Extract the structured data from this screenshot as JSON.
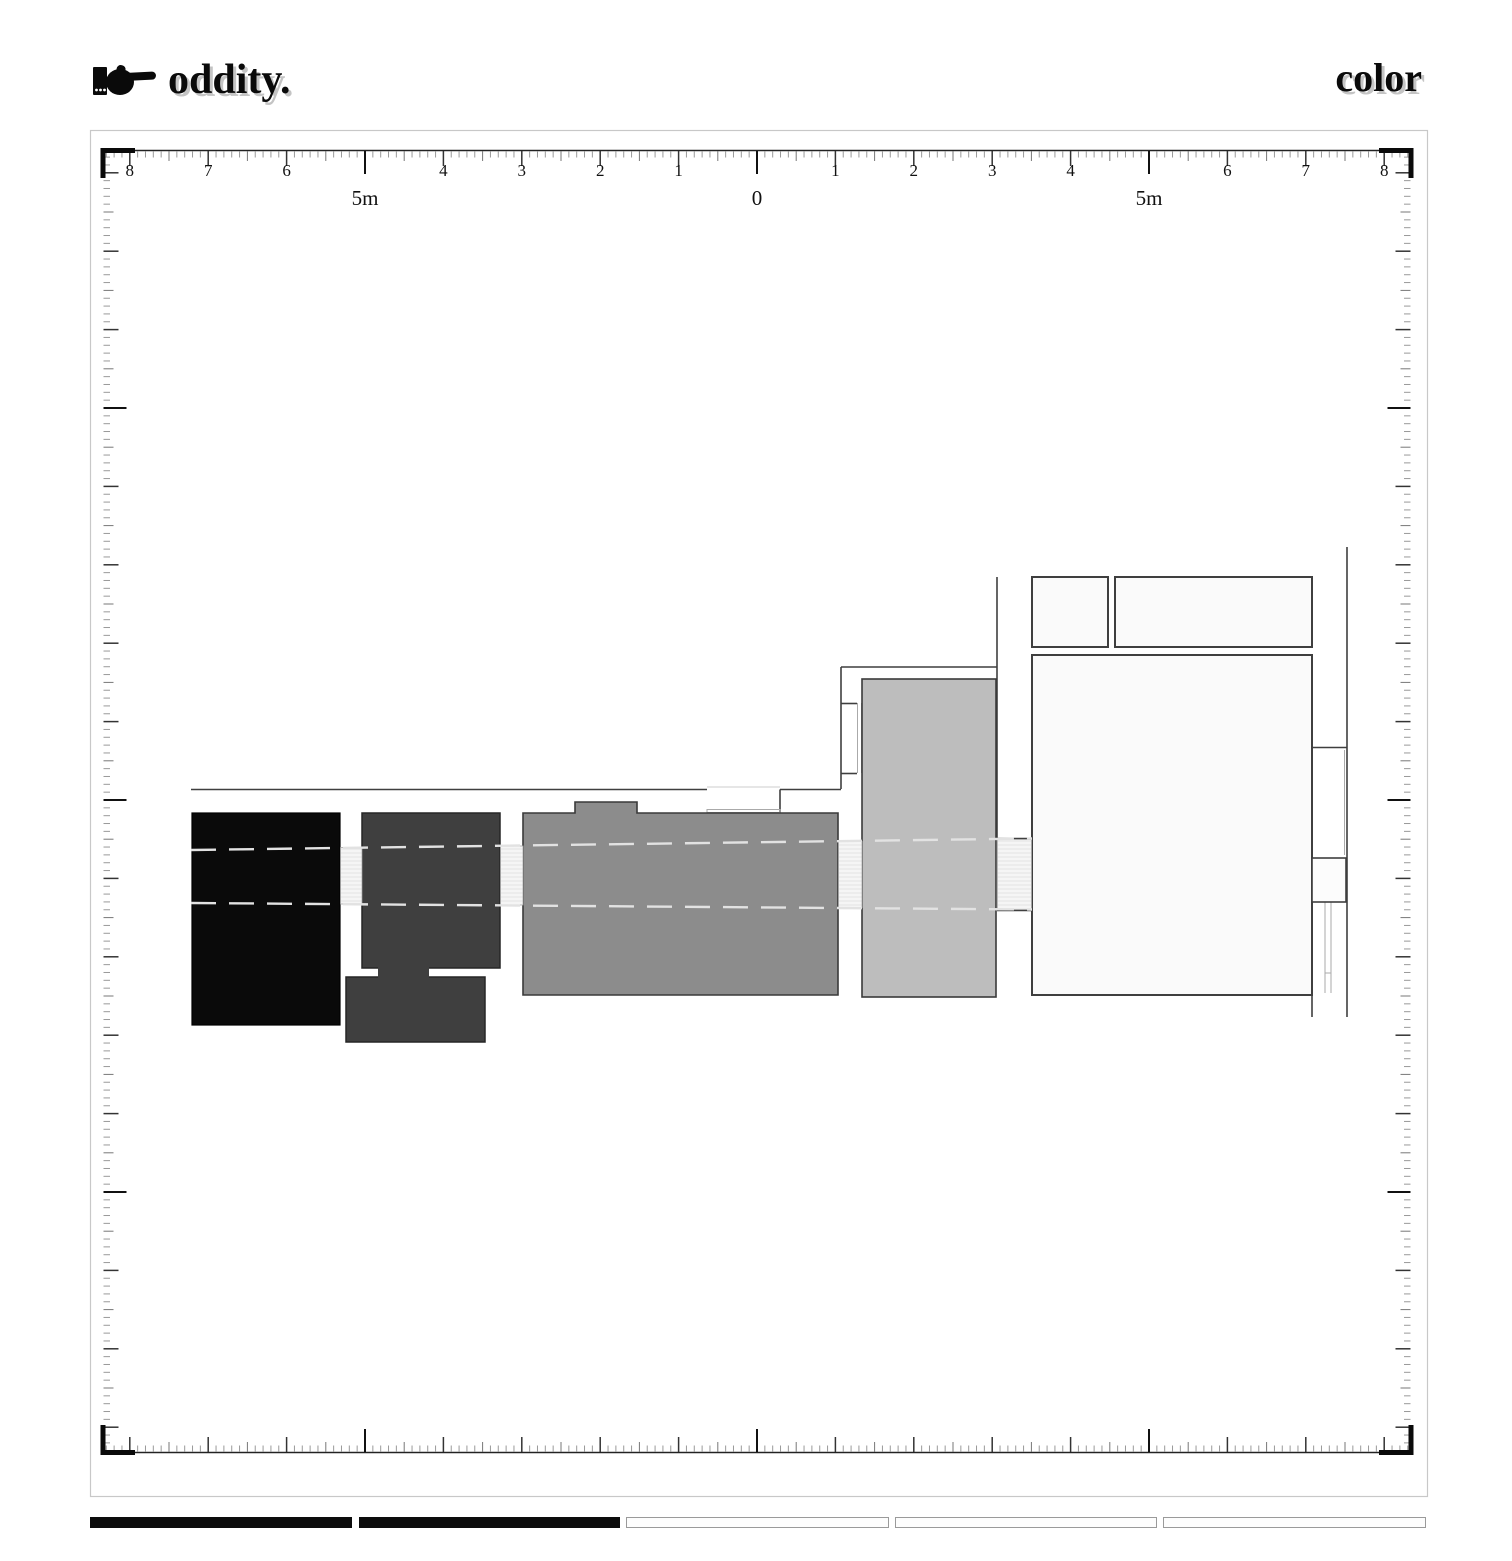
{
  "header": {
    "logo_icon": "manicule-right-pointing-hand",
    "logo_text": "oddity.",
    "page_title": "color"
  },
  "ruler": {
    "px_per_m": 78.4,
    "top": {
      "origin_x": 757,
      "number_labels": [
        "8",
        "7",
        "6",
        "4",
        "3",
        "2",
        "1"
      ],
      "unit_labels": [
        {
          "text": "5m",
          "m": -5
        },
        {
          "text": "0",
          "m": 0
        },
        {
          "text": "5m",
          "m": 5
        }
      ]
    },
    "bottom": {
      "origin_x": 757
    },
    "left": {
      "origin_y": 800
    },
    "right": {
      "origin_y": 800
    }
  },
  "plan": {
    "palette": {
      "block_black": "#0a0a0a",
      "block_dark_gray": "#3f3f3f",
      "block_mid_gray": "#8c8c8c",
      "block_light_gray": "#bdbdbd",
      "room_white": "#fafafa",
      "door_white": "#fcfcfc",
      "wall_line": "#3f3f3f",
      "dashed_line": "#e2e2e2",
      "passage_fill": "#f5f5f5"
    }
  },
  "calibration_strip": {
    "segments": [
      {
        "style": "filled",
        "color": "#0c0c0c"
      },
      {
        "style": "filled",
        "color": "#0c0c0c"
      },
      {
        "style": "outlined",
        "color": "#fdfdfd"
      },
      {
        "style": "outlined",
        "color": "#fdfdfd"
      },
      {
        "style": "outlined",
        "color": "#fdfdfd"
      }
    ]
  }
}
